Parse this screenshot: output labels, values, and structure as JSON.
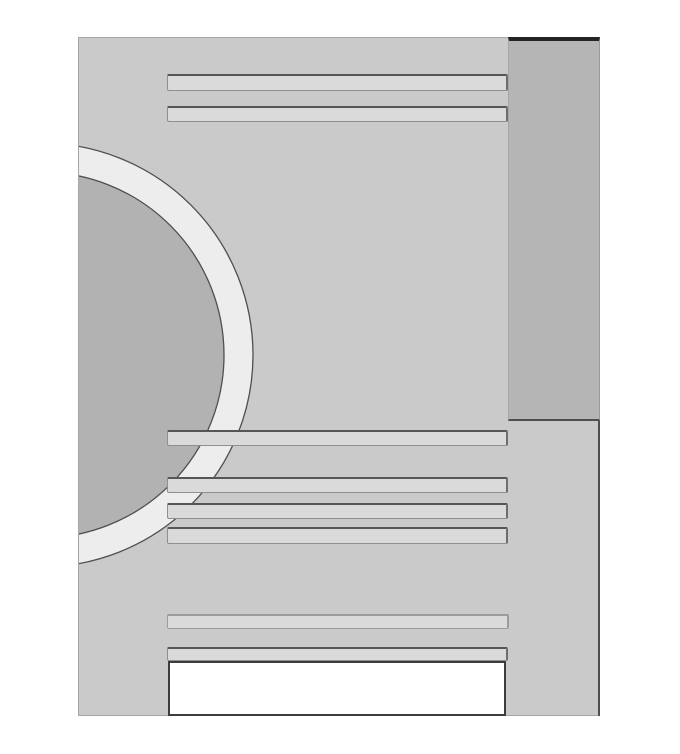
{
  "canvas": {
    "width": 680,
    "height": 754,
    "background": "#ffffff"
  },
  "palette": {
    "background": "#ffffff",
    "page": "#cacaca",
    "column": "#b5b5b5",
    "circle_fill": "#b2b2b2",
    "ring": "#ededed",
    "circle_outline": "#4f4f4f",
    "bar": "#dadada",
    "bar_border_dark": "#565656",
    "bar_border_soft": "#9c9c9c",
    "outline_dark": "#3c3c3c",
    "edge": "#9a9a9a",
    "white": "#ffffff"
  },
  "page": {
    "rect": {
      "x": 78,
      "y": 37,
      "w": 522,
      "h": 679
    }
  },
  "sidebar_block": {
    "rect": {
      "x": 508,
      "y": 37,
      "w": 92,
      "h": 384
    }
  },
  "page_right_edge": {
    "rect": {
      "x": 598,
      "y": 421,
      "w": 2,
      "h": 295
    }
  },
  "circle_figure": {
    "cx": 40,
    "cy": 354,
    "outer_r": 212,
    "inner_r": 183,
    "stroke_width": 1.3
  },
  "bars": [
    {
      "id": "header-line-1",
      "x": 167,
      "y": 74,
      "w": 341,
      "h": 17,
      "style": "normal"
    },
    {
      "id": "header-line-2",
      "x": 167,
      "y": 106,
      "w": 341,
      "h": 16,
      "style": "normal"
    },
    {
      "id": "body-line-1",
      "x": 167,
      "y": 430,
      "w": 341,
      "h": 16,
      "style": "normal"
    },
    {
      "id": "body-line-2",
      "x": 167,
      "y": 477,
      "w": 341,
      "h": 16,
      "style": "normal"
    },
    {
      "id": "body-line-3",
      "x": 167,
      "y": 503,
      "w": 341,
      "h": 16,
      "style": "normal"
    },
    {
      "id": "body-line-4",
      "x": 167,
      "y": 527,
      "w": 341,
      "h": 17,
      "style": "normal"
    },
    {
      "id": "footer-line-1",
      "x": 167,
      "y": 614,
      "w": 342,
      "h": 15,
      "style": "soft"
    },
    {
      "id": "footer-line-2",
      "x": 167,
      "y": 647,
      "w": 341,
      "h": 14,
      "style": "normal"
    }
  ],
  "footer_box": {
    "rect": {
      "x": 168,
      "y": 661,
      "w": 338,
      "h": 55
    }
  }
}
